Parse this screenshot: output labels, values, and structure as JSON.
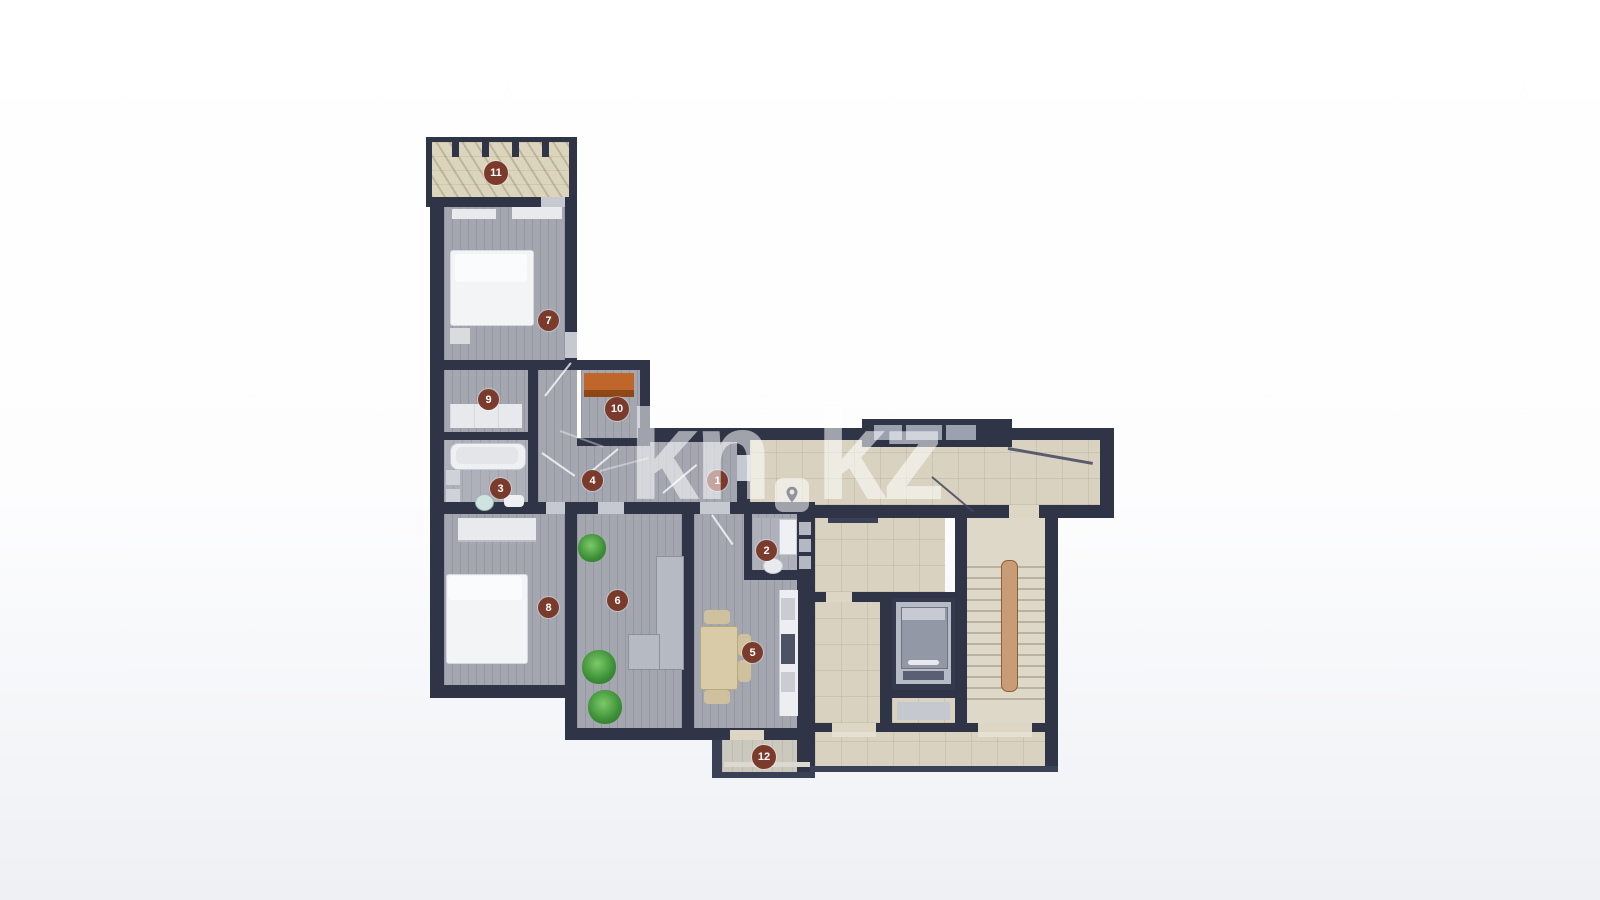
{
  "watermark": {
    "left": "kn",
    "right": "kz",
    "pin_icon": "location-pin-icon"
  },
  "rooms": [
    {
      "label": "1"
    },
    {
      "label": "2"
    },
    {
      "label": "3"
    },
    {
      "label": "4"
    },
    {
      "label": "5"
    },
    {
      "label": "6"
    },
    {
      "label": "7"
    },
    {
      "label": "8"
    },
    {
      "label": "9"
    },
    {
      "label": "10"
    },
    {
      "label": "11"
    },
    {
      "label": "12"
    }
  ],
  "colors": {
    "wall": "#2f3447",
    "apartment_floor_gray": "#a4a7b0",
    "bathroom_floor_gray": "#aeb1b9",
    "common_floor_beige": "#d9d2c0",
    "balcony_hatch_beige": "#dcd5bd",
    "room_marker_maroon": "#7b3b2c",
    "wardrobe_orange": "#c0662a",
    "stair_rail_brown": "#c89c74",
    "plant_green": "#3c8f36",
    "watermark_white": "#ffffff"
  }
}
